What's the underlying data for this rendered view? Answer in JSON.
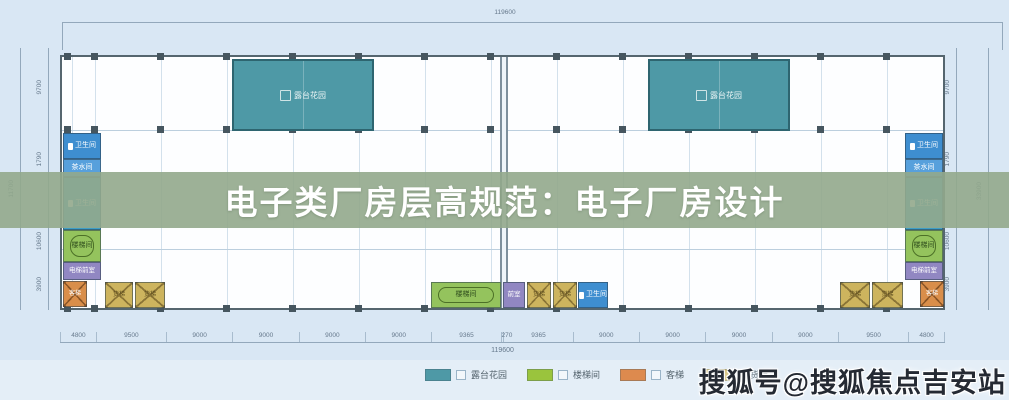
{
  "banner": {
    "title": "电子类厂房层高规范：电子厂房设计"
  },
  "watermark": {
    "text": "搜狐号@搜狐焦点吉安站"
  },
  "dims": {
    "top_total": "119600",
    "bottom_total": "119600",
    "bottom": [
      "4800",
      "9500",
      "9000",
      "9000",
      "9000",
      "9000",
      "9365",
      "270",
      "9365",
      "9000",
      "9000",
      "9000",
      "9000",
      "9500",
      "4800"
    ],
    "left": {
      "outer": "11700",
      "segments": [
        "9700",
        "1790",
        "10600",
        "3900"
      ]
    },
    "right": {
      "outer": "33900",
      "segments": [
        "9700",
        "1790",
        "10600",
        "3900"
      ]
    }
  },
  "rooms": {
    "terrace": "露台花园",
    "toilet": "卫生间",
    "tea_room": "茶水间",
    "stair": "楼梯间",
    "elevator_lobby": "电梯前室",
    "vestibule": "前室",
    "passenger_elevator": "客梯",
    "freight_elevator": "货梯"
  },
  "legend": {
    "items": [
      {
        "label": "露台花园",
        "color": "#4e99a6"
      },
      {
        "label": "楼梯间",
        "color": "#9ac43d"
      },
      {
        "label": "客梯",
        "color": "#dd8a4e"
      },
      {
        "label": "货梯",
        "color": "#cdb45e"
      }
    ]
  }
}
